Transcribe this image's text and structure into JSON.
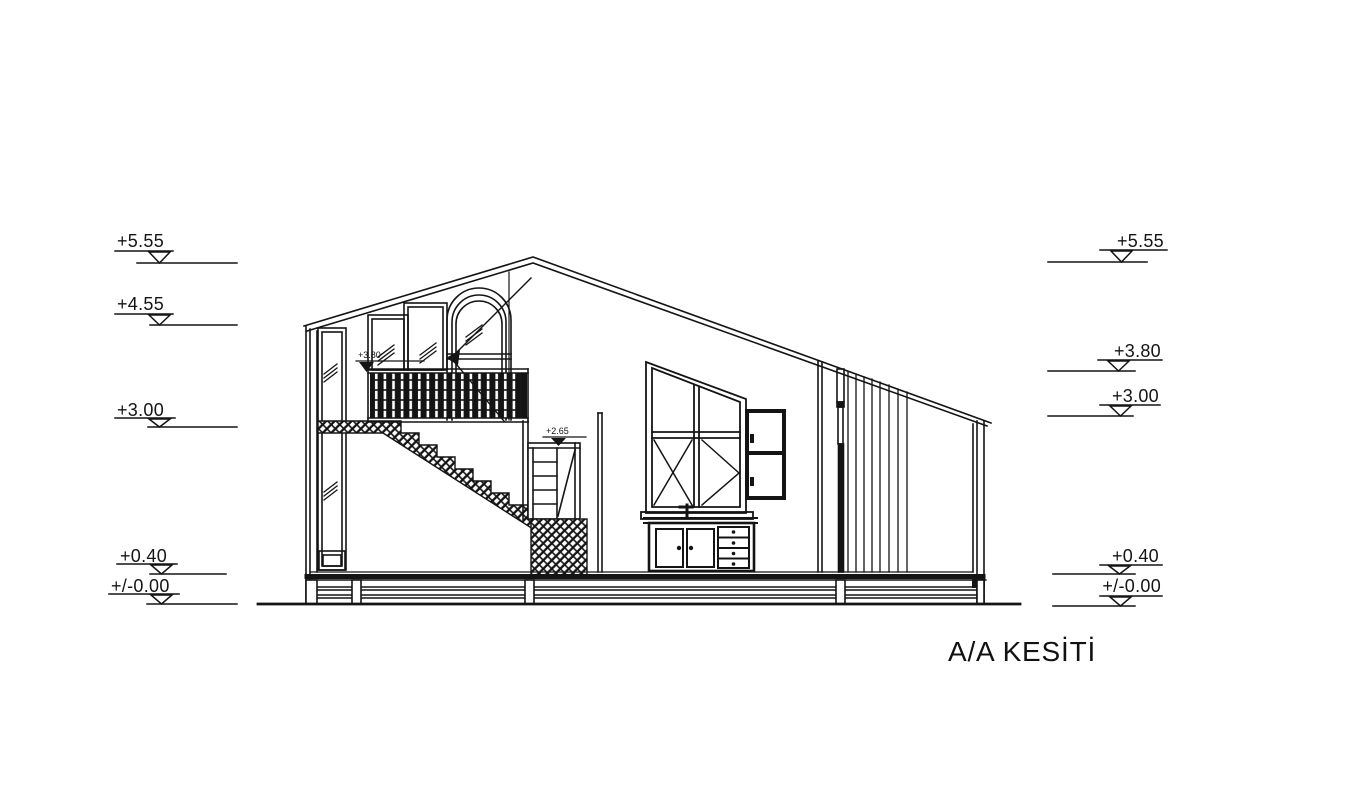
{
  "drawing": {
    "title": "A/A KESİTİ"
  },
  "levels": {
    "left": [
      "+5.55",
      "+4.55",
      "+3.00",
      "+0.40",
      "+/-0.00"
    ],
    "right": [
      "+5.55",
      "+3.80",
      "+3.00",
      "+0.40",
      "+/-0.00"
    ],
    "inline": [
      "+3.80",
      "+2.65"
    ]
  }
}
